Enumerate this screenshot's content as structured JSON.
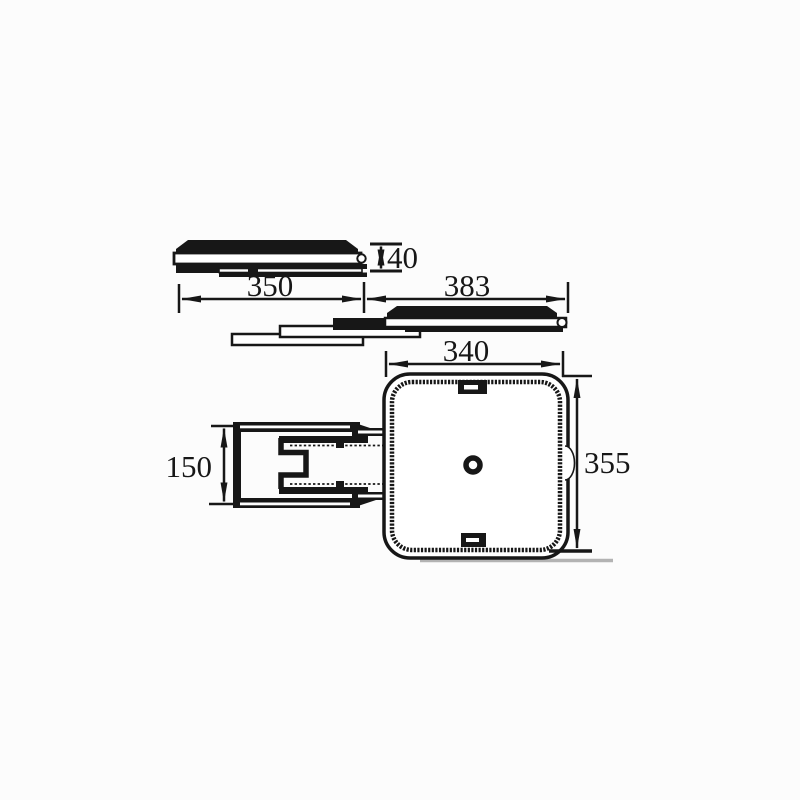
{
  "drawing": {
    "description": "technical dimension drawing of swivel pull-out plate",
    "dimension_labels": {
      "stack_height": "40",
      "closed_length": "350",
      "extension_length": "383",
      "plate_width": "340",
      "plate_depth": "355",
      "bracket_width": "150"
    },
    "colors": {
      "line": "#171717",
      "background": "#fcfcfc",
      "shadow": "#b3b3b3"
    }
  }
}
